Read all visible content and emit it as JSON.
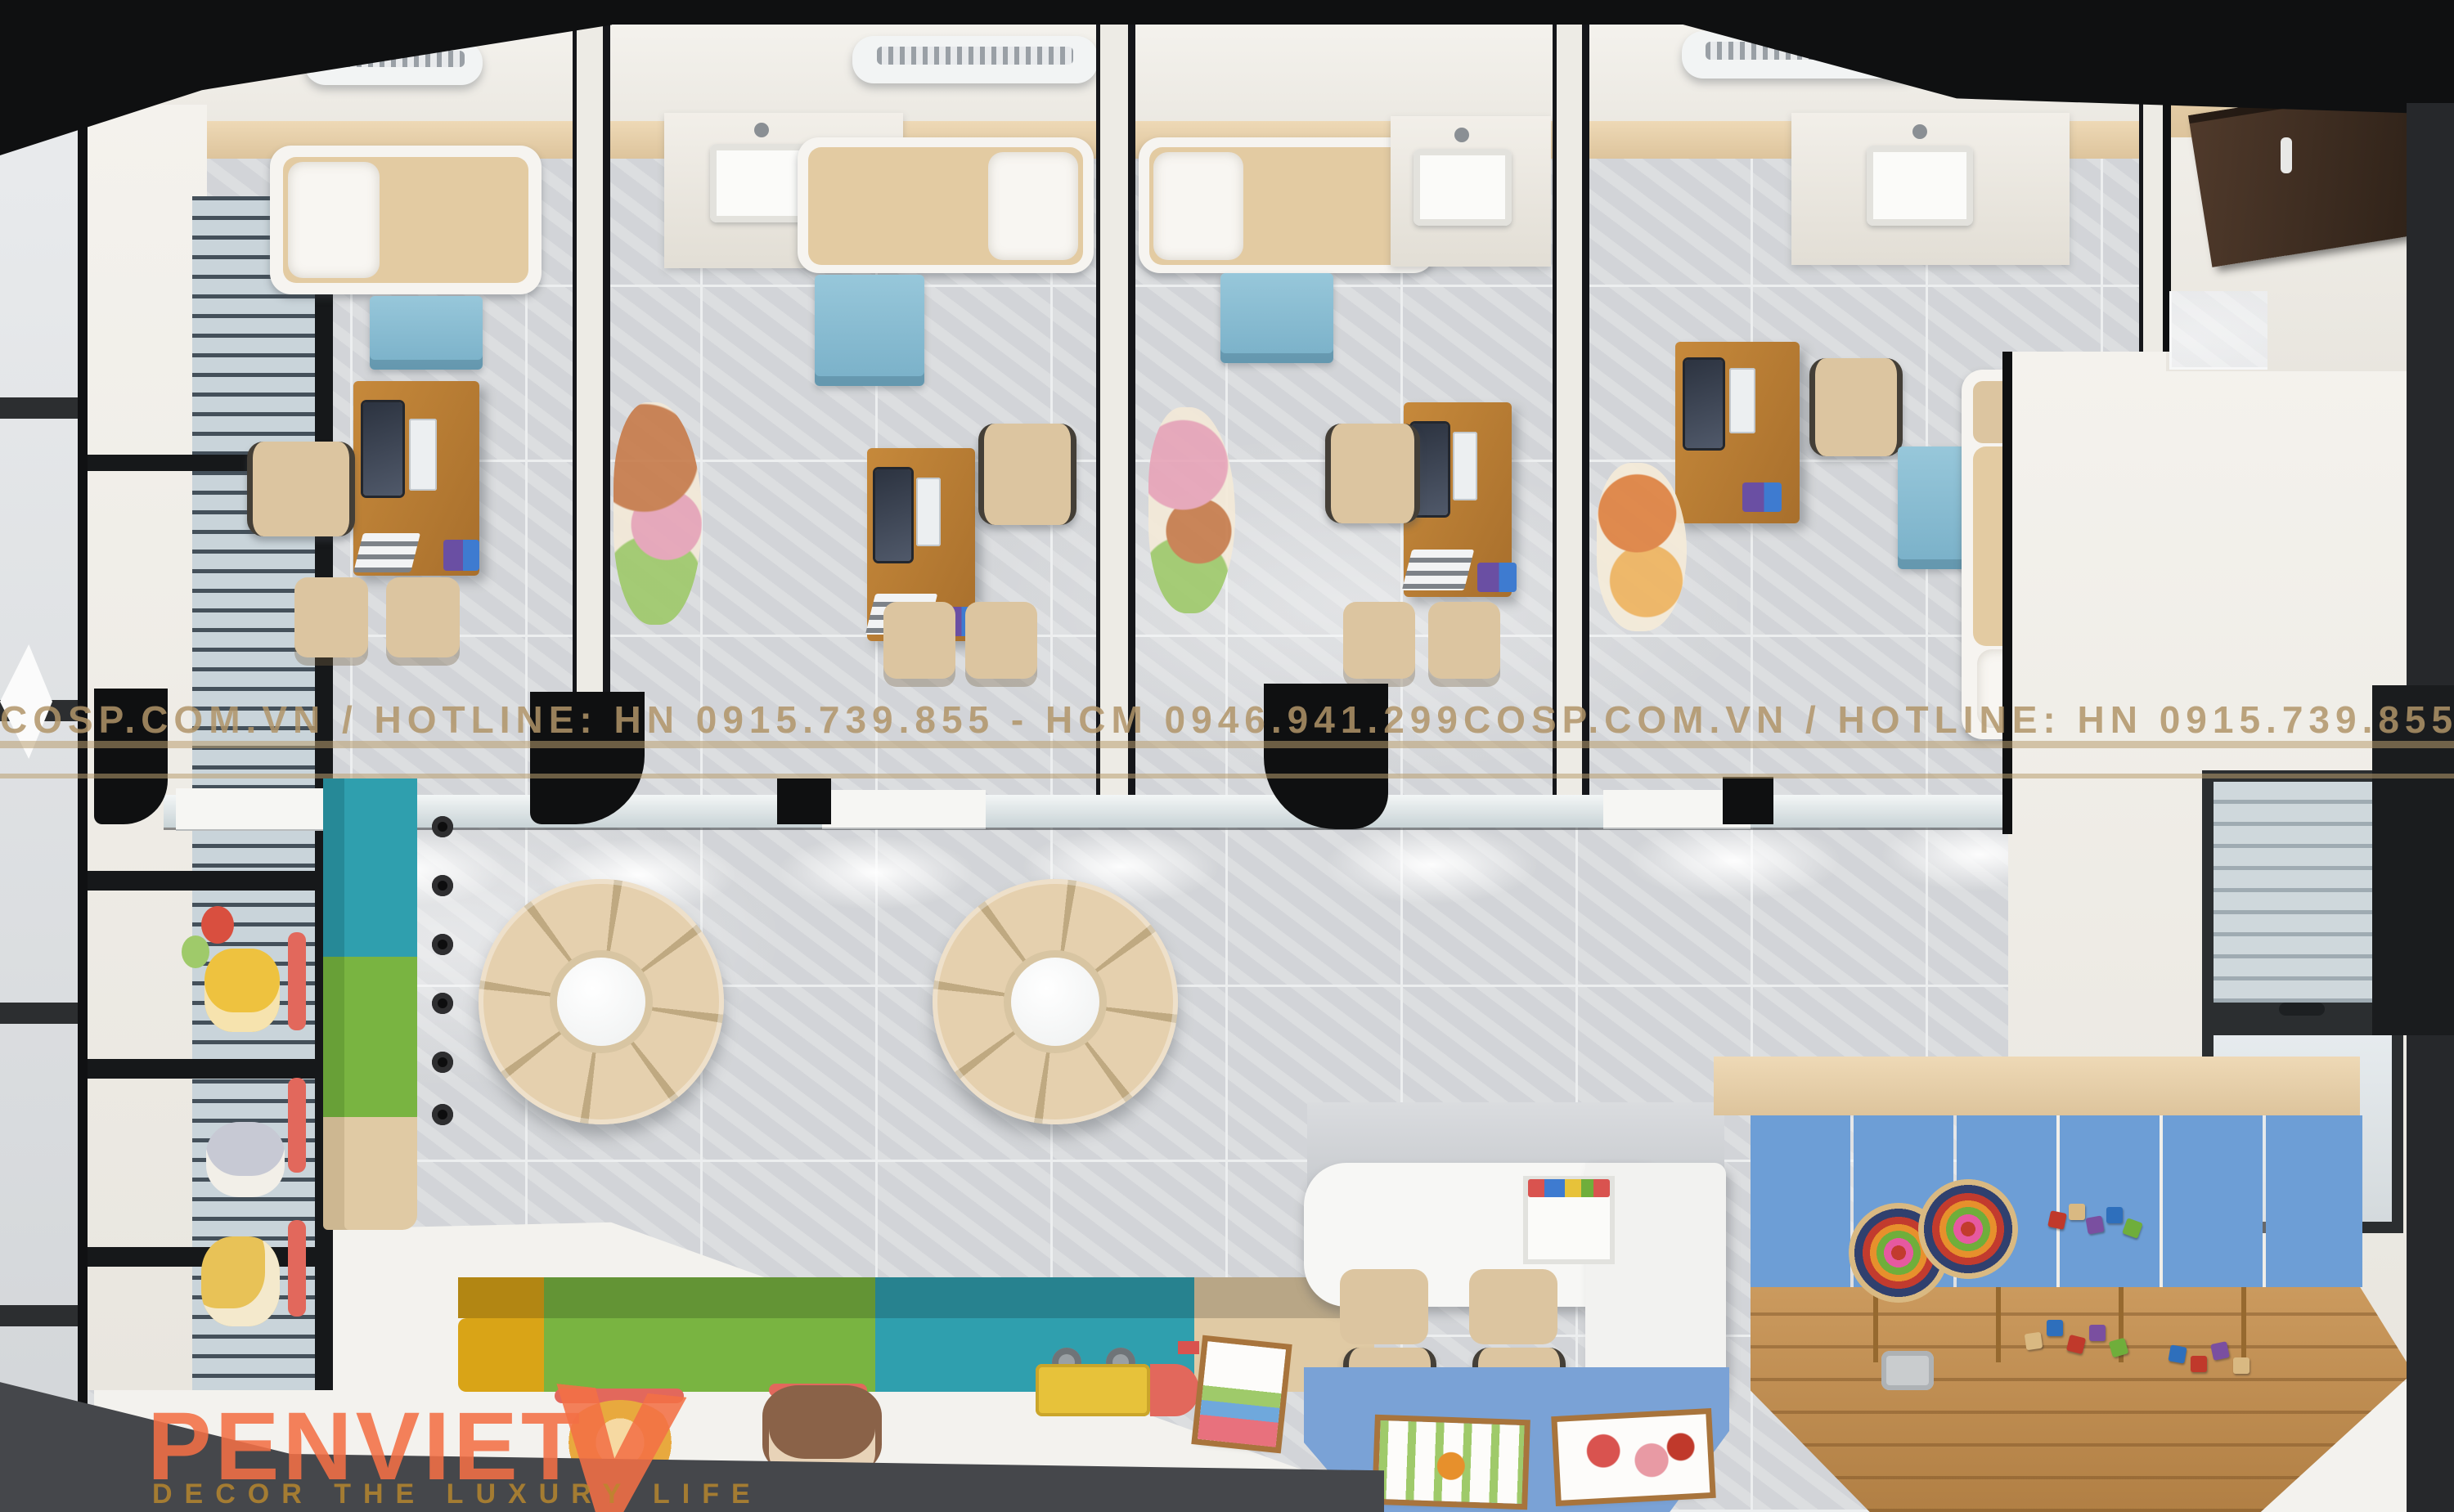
{
  "watermark": {
    "text": "Cosp.com.vn / Hotline: HN 0915.739.855 - HCM 0946.941.299",
    "color": "#b09468"
  },
  "logo": {
    "name": "PENVIET",
    "tagline": "DECOR THE LUXURY LIFE",
    "name_color": "#f37046",
    "tagline_color": "#c3922e"
  },
  "signs": {
    "wc": "WC"
  },
  "scene": {
    "type": "pediatric-clinic-interior-top-down-render",
    "exam_rooms": 4,
    "waiting_area": [
      "circular-donut-sofa",
      "circular-donut-sofa",
      "color-block-bench-left",
      "color-block-bench-bottom",
      "cartoon-floor-decals"
    ],
    "play_zone": [
      "blue-soft-mat",
      "wooden-deck-shelves",
      "ring-stack-toys",
      "building-blocks"
    ],
    "reception": [
      "white-rounded-desk",
      "two-beige-chairs",
      "blue-floor-mat",
      "two-poster-boards"
    ]
  },
  "palette": {
    "tile": "#d8dadd",
    "grout": "#eceeef",
    "white-floor": "#f3f2ee",
    "wall-white": "#f1efe9",
    "ceiling-beige": "#e7d1ad",
    "mattress": "#e3cba2",
    "bed-frame": "#f6f4f0",
    "pillow": "#f8f6f2",
    "blue-cabinet": "#87bdd4",
    "wood": "#c6893b",
    "wood-dark": "#a86f2c",
    "chair": "#dcc5a0",
    "teal": "#2f9fae",
    "green": "#79b441",
    "yellow": "#d9a417",
    "tan": "#e0caa4",
    "donut": "#e5d0ae",
    "donut-seam": "#bfa981",
    "blue-mat": "#7aa2d6",
    "play-blue": "#6d9ed6",
    "deck": "#c28f52",
    "watermark": "#b09468",
    "logo-orange": "#f37046",
    "logo-gold": "#c3922e",
    "wc-blue": "#3a6fc4",
    "decal-red": "#e2685c",
    "door-wood": "#473325",
    "frame-black": "#0f1011",
    "bottom-band": "#45474b"
  }
}
